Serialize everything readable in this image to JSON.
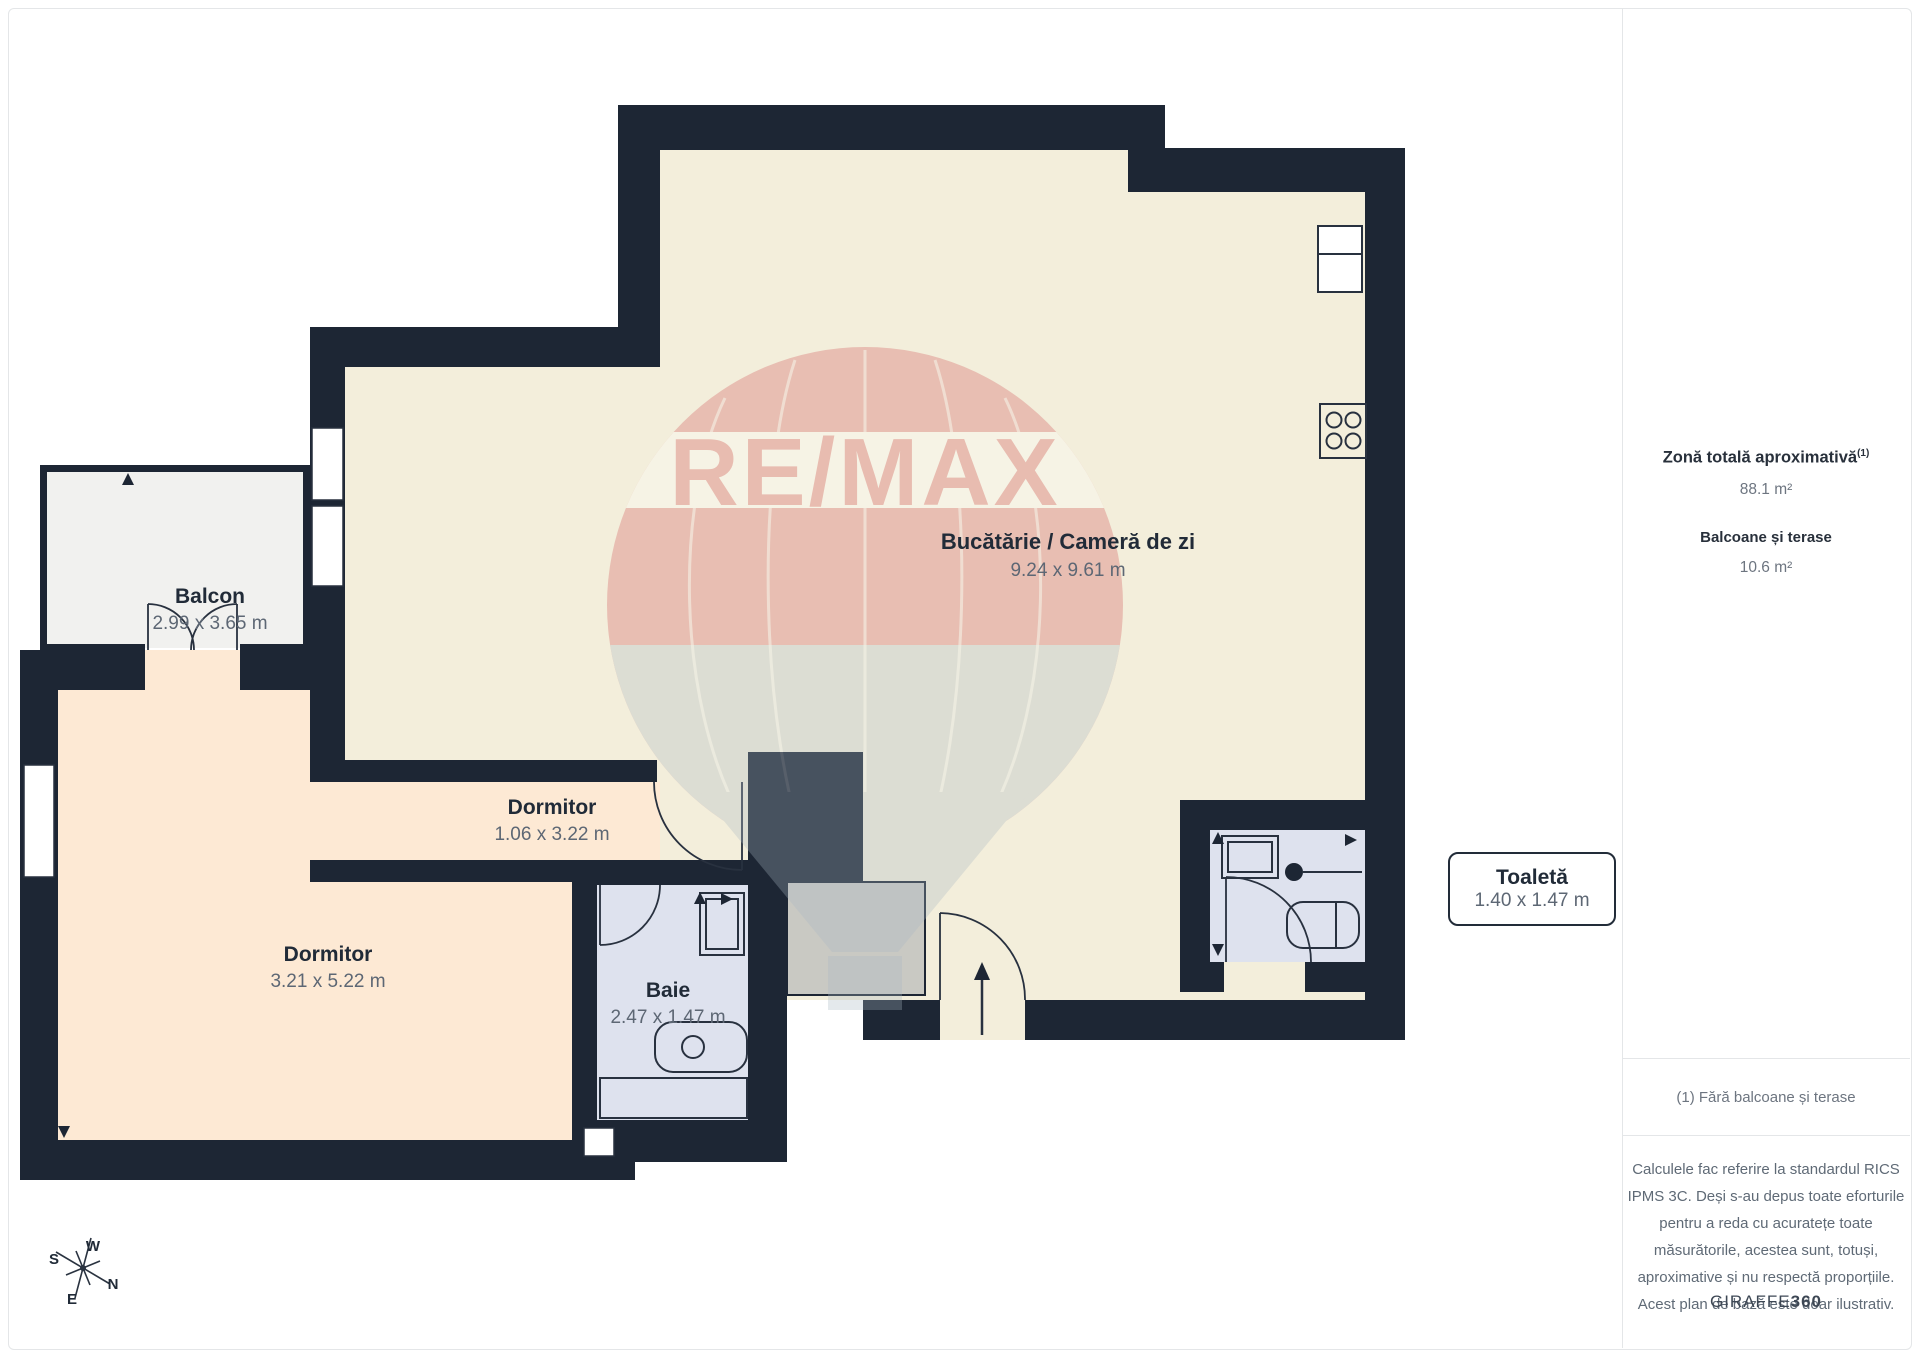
{
  "rooms": {
    "balcony": {
      "name": "Balcon",
      "dims": "2.99 x 3.65 m"
    },
    "kitchen_living": {
      "name": "Bucătărie / Cameră de zi",
      "dims": "9.24 x 9.61 m"
    },
    "bedroom_small": {
      "name": "Dormitor",
      "dims": "1.06 x 3.22 m"
    },
    "bedroom_large": {
      "name": "Dormitor",
      "dims": "3.21 x 5.22 m"
    },
    "bathroom": {
      "name": "Baie",
      "dims": "2.47 x 1.47 m"
    },
    "toilet": {
      "name": "Toaletă",
      "dims": "1.40 x 1.47 m"
    }
  },
  "sidebar": {
    "total_area_label": "Zonă totală aproximativă",
    "total_area_superscript": "(1)",
    "total_area_value": "88.1 m²",
    "balconies_label": "Balcoane și terase",
    "balconies_value": "10.6 m²",
    "footnote": "(1) Fără balcoane și terase",
    "disclaimer": "Calculele fac referire la standardul RICS IPMS 3C. Deși s-au depus toate eforturile pentru a reda cu acuratețe toate măsurătorile, acestea sunt, totuși, aproximative și nu respectă proporțiile. Acest plan de bază este doar ilustrativ.",
    "brand_prefix": "GIRAFFE",
    "brand_suffix": "360"
  },
  "compass": {
    "w": "W",
    "s": "S",
    "n": "N",
    "e": "E"
  },
  "watermark": {
    "text": "RE/MAX"
  },
  "colors": {
    "wall": "#1d2634",
    "floor_main": "#f3eedb",
    "floor_bedroom": "#fde9d4",
    "floor_bath": "#dee2ee",
    "floor_balcony": "#f1f1ef",
    "closet": "#c9c9c3",
    "brand_red": "#cf4b50",
    "label_name": "#212b38",
    "label_dims": "#5d6774"
  }
}
